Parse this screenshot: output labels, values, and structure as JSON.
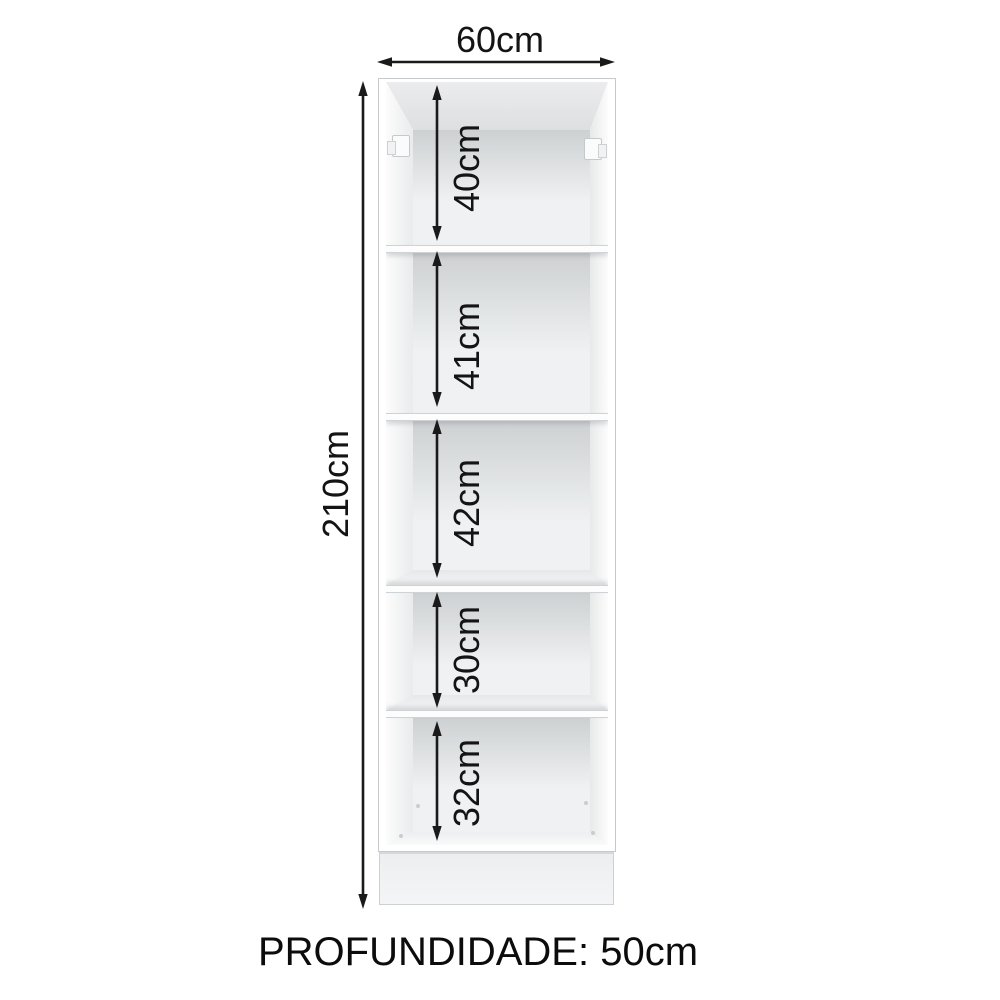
{
  "diagram": {
    "width_label": "60cm",
    "height_label": "210cm",
    "depth_label": "PROFUNDIDADE: 50cm",
    "compartments": [
      {
        "label": "40cm"
      },
      {
        "label": "41cm"
      },
      {
        "label": "42cm"
      },
      {
        "label": "30cm"
      },
      {
        "label": "32cm"
      }
    ],
    "colors": {
      "dimension_line": "#1a1a1a",
      "text": "#141414",
      "cabinet_edge": "#c6cacd",
      "cabinet_white": "#ffffff",
      "interior_back": "#eff1f2",
      "plinth": "#eceeef"
    }
  }
}
